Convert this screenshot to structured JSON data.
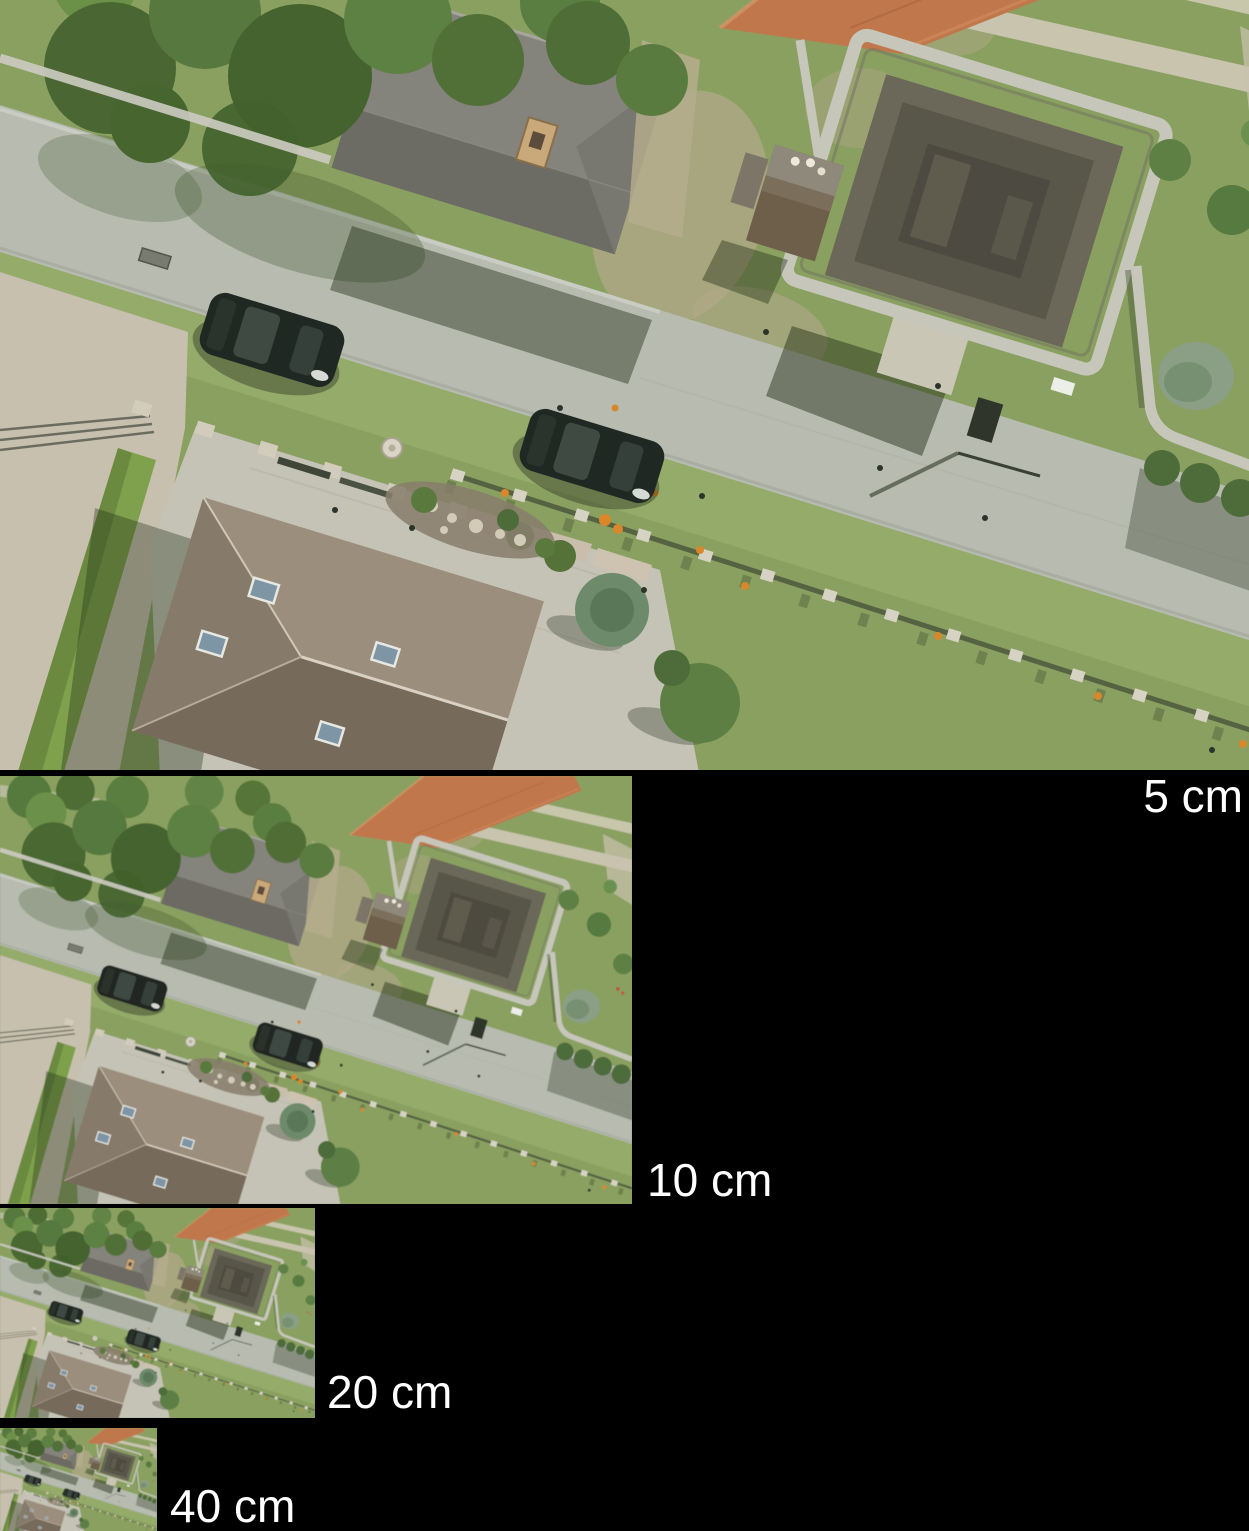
{
  "figure": {
    "background_color": "#000000",
    "label_color": "#ffffff",
    "panels": [
      {
        "id": "gsd-5cm",
        "label": "5 cm"
      },
      {
        "id": "gsd-10cm",
        "label": "10 cm"
      },
      {
        "id": "gsd-20cm",
        "label": "20 cm"
      },
      {
        "id": "gsd-40cm",
        "label": "40 cm"
      }
    ]
  },
  "palette": {
    "background_color": "#000000",
    "label_color": "#ffffff",
    "lawn": "#8aa061",
    "lawn_light": "#95ab6a",
    "road": "#b7bbb0",
    "gravel": "#c8c0ae",
    "paver": "#c5c3b6",
    "wall_stone": "#c6c6ba",
    "roof_gray": "#84837c",
    "roof_brown": "#9c8e7c",
    "roof_orange": "#c0774b",
    "stone_roof": "#59564a",
    "tree_green": "#577940",
    "hedge_green": "#7fa04c",
    "car_body": "#202823",
    "skylight_blue": "#7e95a6",
    "flower_orange": "#d8882a"
  }
}
